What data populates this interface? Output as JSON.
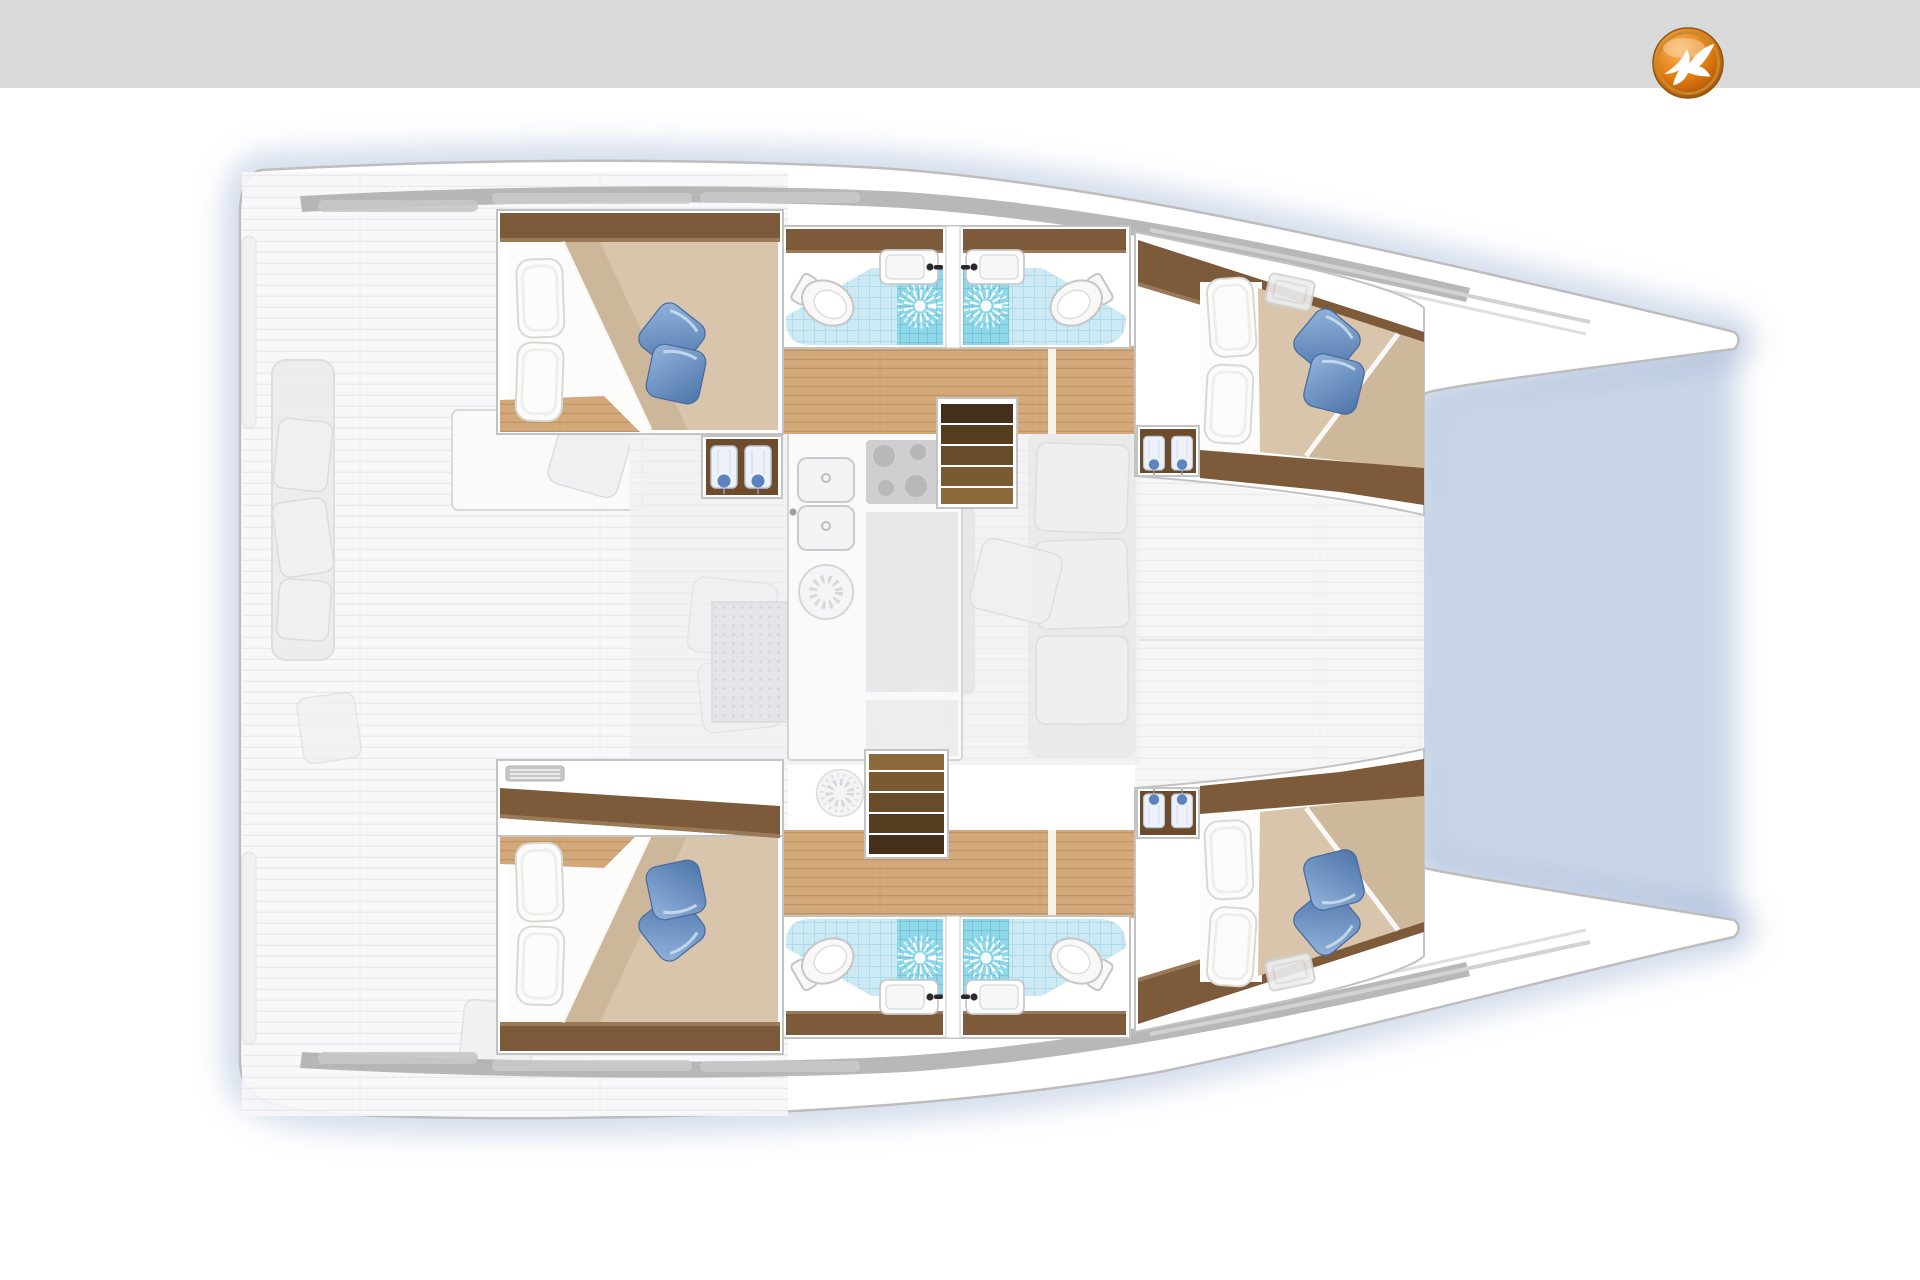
{
  "header": {
    "bar_color": "#d9d9d9",
    "logo": {
      "name": "yacht-broker-bird-logo",
      "colors": {
        "orange_light": "#f9b559",
        "orange_mid": "#e07a10",
        "orange_dark": "#9c4a04",
        "ring": "#c98a2e",
        "bird": "#ffffff"
      }
    }
  },
  "plan": {
    "type": "catamaran-floorplan-top-view",
    "rooms": [
      "aft-cabin-port",
      "fore-cabin-port",
      "bathroom-port-aft",
      "bathroom-port-fore",
      "aft-cabin-starboard",
      "fore-cabin-starboard",
      "bathroom-starboard-aft",
      "bathroom-starboard-fore",
      "salon-galley",
      "cockpit-deck",
      "foredeck"
    ],
    "icon_features": [
      "double-berth x4",
      "white-pillows",
      "blue-deco-pillows",
      "toilet x4",
      "shower-rose x4",
      "washbasin x4",
      "hanging-locker-with-shirts x4",
      "companionway-stairs x2",
      "galley-double-sink",
      "four-burner-cooktop",
      "deck-hatch x2"
    ],
    "palette": {
      "page_bg": "#ffffff",
      "topbar": "#d9d9d9",
      "hull_fill": "#ffffff",
      "hull_stroke": "#bdbdbd",
      "water_shadow": "#9fb4d6",
      "deck_fill": "#f7f7f9",
      "deck_line": "#e8e8ec",
      "rim_gray": "#a6a6a6",
      "window_gray": "#c6c6c6",
      "salon_fill": "#f1f1f3",
      "salon_item": "#e3e3e7",
      "wood_floor": "#d3a87a",
      "wood_line": "#bd8f5e",
      "wood_dark": "#7c5a3a",
      "wood_dark_hi": "#9a7a56",
      "wardrobe_brown": "#6e4b2b",
      "duvet": "#d8c5ab",
      "duvet_shadow": "#c3ac8e",
      "mattress": "#fdfcfa",
      "pillow_fill": "#fbfbfa",
      "pillow_stroke": "#d9d9d4",
      "pillow_blue_1": "#93b4dd",
      "pillow_blue_2": "#4c74a8",
      "pillow_blue_stroke": "#44699e",
      "tile_fill": "#cdeaf4",
      "tile_line": "#96cde2",
      "shower_fill": "#8fd8ea",
      "shower_line": "#5aafc8",
      "porcelain": "#f8f8f6",
      "porcelain_stroke": "#c5c5c5",
      "faucet_dark": "#2b2b2b",
      "stair_1": "#8c6a3c",
      "stair_2": "#7a5a31",
      "stair_3": "#684b28",
      "stair_4": "#563d20",
      "stair_5": "#44301a",
      "vent_gray": "#c6c6c6",
      "shirt_body": "#edf2f9",
      "shirt_accent": "#5b83c0"
    }
  }
}
